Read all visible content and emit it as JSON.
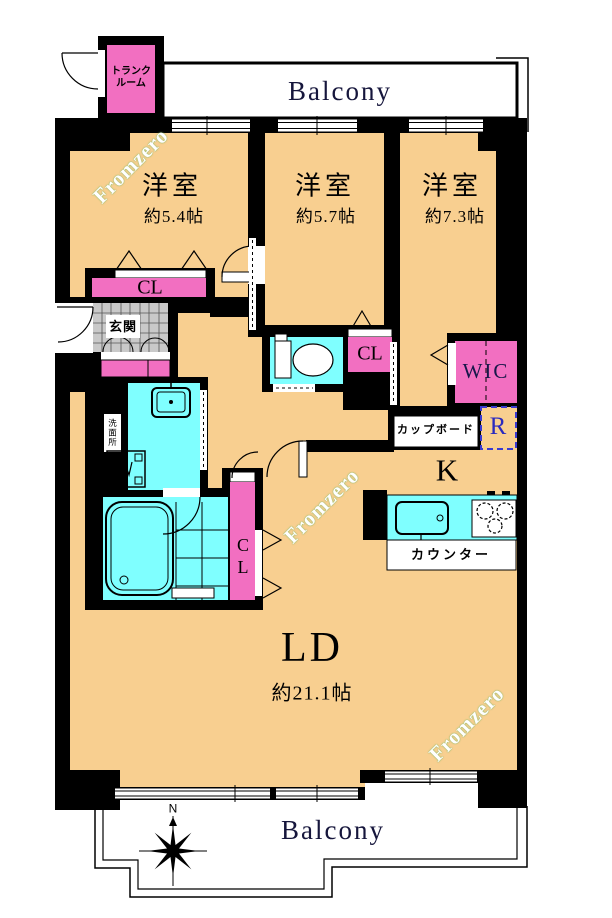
{
  "title": "apartment-floor-plan",
  "colors": {
    "floor_tan": "#F8CF90",
    "fixture_pink": "#F26FC1",
    "fixture_cyan": "#7FFFFF",
    "tile_gray": "#C9C9C9",
    "wall_black": "#000000",
    "balcony_text": "#16163C",
    "refrigerator_blue": "#2A2ABF"
  },
  "balcony_top": {
    "label": "Balcony"
  },
  "balcony_bottom": {
    "label": "Balcony"
  },
  "compass": {
    "north_label": "N"
  },
  "trunk_room": {
    "line1": "トランク",
    "line2": "ルーム"
  },
  "rooms": {
    "bedroom1": {
      "name": "洋室",
      "size": "約5.4帖"
    },
    "bedroom2": {
      "name": "洋室",
      "size": "約5.7帖"
    },
    "bedroom3": {
      "name": "洋室",
      "size": "約7.3帖"
    },
    "living_dining": {
      "name": "LD",
      "size": "約21.1帖"
    },
    "kitchen": {
      "name": "K"
    }
  },
  "fixtures": {
    "closet1": "CL",
    "closet2": "CL",
    "closet3_line1": "C",
    "closet3_line2": "L",
    "walk_in_closet": "WIC",
    "entrance": "玄関",
    "cupboard": "カップボード",
    "refrigerator": "R",
    "counter": "カウンター",
    "washroom": "洗面所"
  },
  "watermark": {
    "text": "Fromzero"
  }
}
